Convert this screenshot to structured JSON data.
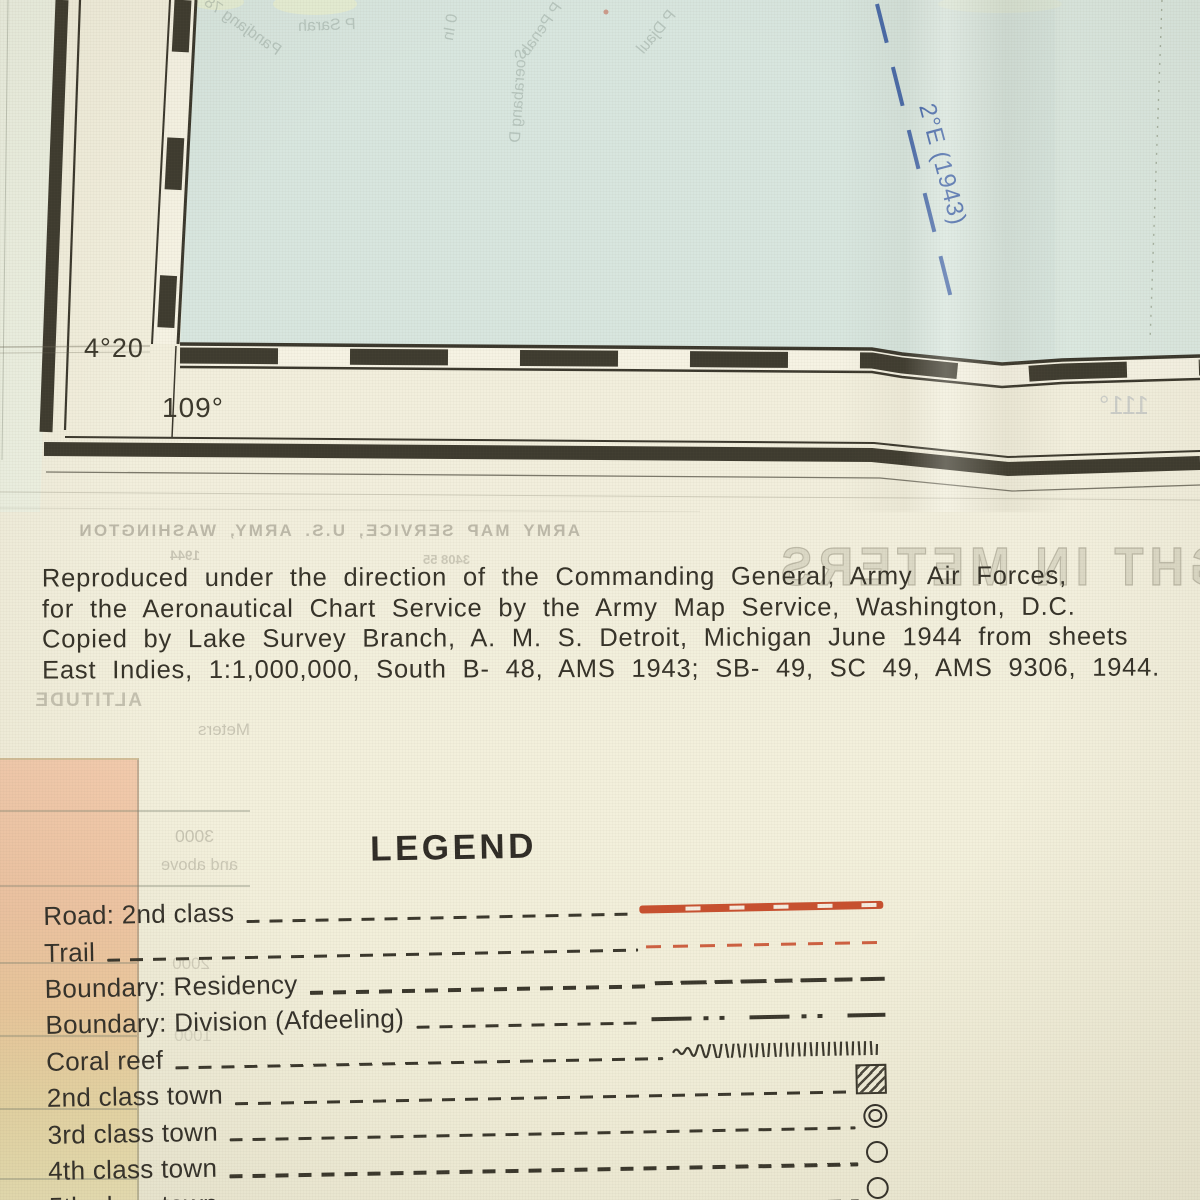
{
  "map": {
    "corner_latitude": "4°20",
    "longitude_label": "109°",
    "longitude_bleed": "111°",
    "isogonic_label": "2°E (1943)",
    "bleed_names": {
      "n1": "Pandjang 78",
      "n2": "P Sarah",
      "n3": "0 In",
      "n4": "P Penab",
      "n5": "Soerabang D",
      "n6": "P Djaul"
    }
  },
  "bleed": {
    "stamp": "ARMY MAP SERVICE, U.S. ARMY, WASHINGTON",
    "code": "3408 55",
    "year": "1944",
    "height_meters": "HEIGHT IN METERS",
    "altitude": "ALTITUDE",
    "meters": "Meters",
    "elev_3000": "3000",
    "elev_above": "and above",
    "elev_2000": "2000",
    "elev_1000": "1000"
  },
  "attribution": {
    "line1": "Reproduced under the direction of the Commanding General, Army Air Forces,",
    "line2": "for the Aeronautical Chart Service by the Army Map Service, Washington, D.C.",
    "line3": "Copied by Lake Survey Branch, A. M. S. Detroit, Michigan June 1944 from sheets",
    "line4": "East Indies, 1:1,000,000, South B- 48, AMS 1943; SB- 49, SC 49, AMS 9306, 1944."
  },
  "legend": {
    "title": "LEGEND",
    "items": [
      {
        "label": "Road: 2nd class"
      },
      {
        "label": "Trail"
      },
      {
        "label": "Boundary: Residency"
      },
      {
        "label": "Boundary: Division (Afdeeling)"
      },
      {
        "label": "Coral reef"
      },
      {
        "label": "2nd class town"
      },
      {
        "label": "3rd class town"
      },
      {
        "label": "4th class town"
      },
      {
        "label": "5th class town"
      }
    ]
  },
  "colors": {
    "ink": "#35322b",
    "road_red": "#c8502f",
    "isogonic_blue": "#3c60a6",
    "water": "#d8e6df",
    "paper": "#f1eedc",
    "tint_pink": "#f2c9ab"
  }
}
